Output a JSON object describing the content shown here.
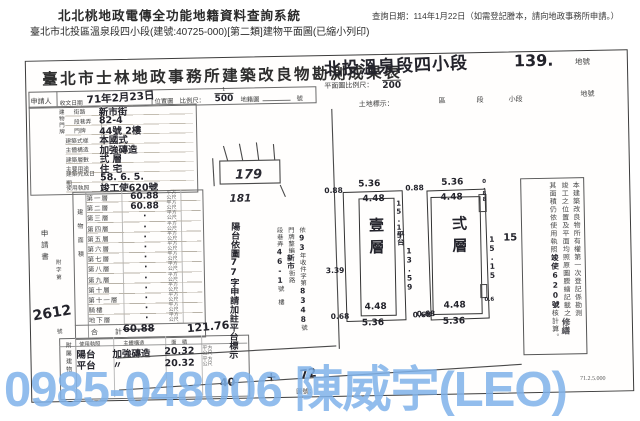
{
  "header": {
    "system_title": "北北桃地政電傳全功能地籍資料查詢系統",
    "query_date": "查詢日期：114年1月22日（如需登記謄本，請向地政事務所申請。）",
    "subtitle": "臺北市北投區溫泉段四小段(建號:40725-000)[第二類]建物平面圖(已縮小列印)"
  },
  "doc": {
    "title": "臺北市士林地政事務所建築改良物勘測成果表",
    "section_hw": "北投溫泉段四小段",
    "lot_no": "139.",
    "lot_suffix": "地號",
    "plan_scale_label": "平面圖比例尺：",
    "plan_scale_num": "1",
    "plan_scale_den": "200",
    "land_label": "土地標示：",
    "land_district": "區",
    "land_section": "段",
    "land_subsection": "小段",
    "land_lot": "地號",
    "applicant": "申請人",
    "recv_label": "收文日期",
    "recv_date": "71年2月23日",
    "loc_label": "位置圖　比例尺：",
    "loc_num": "1",
    "loc_den": "500",
    "cad_label": "地籍圖",
    "cad_suffix": "號"
  },
  "form": {
    "group_label": "建物門牌",
    "rows": [
      {
        "label": "街路",
        "value": "新市街",
        "indent": true
      },
      {
        "label": "段巷弄",
        "value": "82-4",
        "indent": true
      },
      {
        "label": "門牌",
        "value": "44號 2樓",
        "indent": true
      },
      {
        "label": "建築式樣",
        "value": "本國式"
      },
      {
        "label": "主體構造",
        "value": "加強磚造"
      },
      {
        "label": "建築層數",
        "value": "弍 層"
      },
      {
        "label": "主要用途",
        "value": "住 宅"
      },
      {
        "label": "建築完成日期",
        "value": "58. 6. 5."
      },
      {
        "label": "使用執照",
        "value": "竣工使620號"
      }
    ]
  },
  "floor_table": {
    "group_label": "建物面積",
    "unit": "平方公尺",
    "rows": [
      {
        "label": "第一層",
        "value": "60.88"
      },
      {
        "label": "第二層",
        "value": "60.88"
      },
      {
        "label": "第三層",
        "value": "·"
      },
      {
        "label": "第四層",
        "value": "·"
      },
      {
        "label": "第五層",
        "value": "·"
      },
      {
        "label": "第六層",
        "value": "·"
      },
      {
        "label": "第七層",
        "value": "·"
      },
      {
        "label": "第八層",
        "value": "·"
      },
      {
        "label": "第九層",
        "value": "·"
      },
      {
        "label": "第十層",
        "value": "·"
      },
      {
        "label": "第十一層",
        "value": "·"
      },
      {
        "label": "騎樓",
        "value": "·"
      },
      {
        "label": "地下層",
        "value": "·"
      }
    ],
    "total_label": "合　計",
    "total_old": "60.88",
    "total_new": "121.76"
  },
  "application": {
    "vert_label": "申請書",
    "ref_label": "附字第",
    "ref_suffix": "號",
    "ref_no": "2612"
  },
  "attached": {
    "group_label": "附屬建物",
    "headers": {
      "use": "使用執照",
      "structure": "主體構造",
      "area": "面　積"
    },
    "unit": "平方公尺",
    "rows": [
      {
        "use": "陽台",
        "structure": "加強磚造",
        "area": "20.32"
      },
      {
        "use": "平台",
        "structure": "〃",
        "area": "20.32"
      }
    ],
    "total": "40",
    "plus": "+"
  },
  "sketch": {
    "lot_a": "179",
    "lot_b": "181"
  },
  "plans": {
    "left": {
      "name": "壹層",
      "top_outer": "5.36",
      "top_inner": "4.48",
      "bottom_inner": "4.48",
      "bottom_outer": "5.36",
      "corner_tl": "0.88",
      "corner_bl": "0.68",
      "side_left": "3.39",
      "terrace": "平台",
      "terrace_dim": "15.15",
      "mid_dim": "13.59"
    },
    "right": {
      "name": "弍層",
      "top_outer": "5.36",
      "top_inner": "4.48",
      "bottom_inner": "4.48",
      "bottom_outer": "5.36",
      "corner_bl": "0.68",
      "right_dim": "15.15",
      "notch_top": "0.88",
      "notch_bottom": "0.6"
    },
    "between_top": "0.88",
    "between_bottom": "0.68"
  },
  "stamps": {
    "renumber": {
      "col1_pre": "依",
      "col1_hw": "93",
      "col1_mid": "年收件字第",
      "col1_no": "8348",
      "col1_suf": "號",
      "col2_pre": "門牌整編",
      "col2_hw": "新市",
      "col2_suf": "街路",
      "col3_pre": "段巷弄",
      "col3_hw": "46-1",
      "col3_suf": "號　樓"
    },
    "note_hw": "陽台依圖77字申請加註平台標示",
    "repair_hw": "修繕",
    "cert": {
      "line1": "本建築改良物所有權第一次登記係勘測",
      "line2": "竣工之位置及平面均照原圖謄繪記載之",
      "line3_pre": "其面積仍依使用執照",
      "line3_hw": "竣使620號",
      "line3_suf": "核計算。"
    },
    "side_hw": "15"
  },
  "footer": {
    "map_no": "圖號：",
    "print_code": "71.2.5.000",
    "hw_mark": "72"
  },
  "watermark": {
    "text": "0985-048006 陳威宇(LEO)",
    "color": "#7fb2ea"
  }
}
